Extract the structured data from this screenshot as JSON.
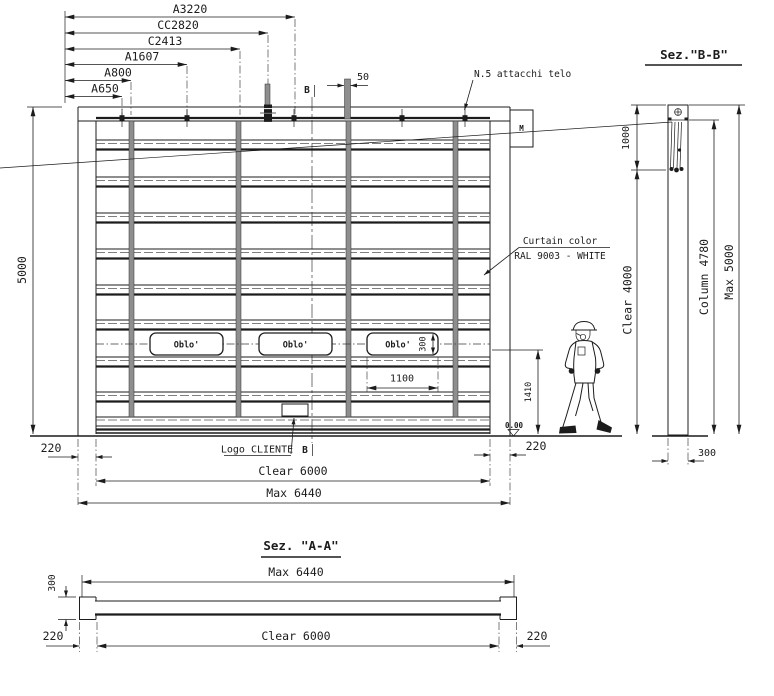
{
  "colors": {
    "ink": "#1c1c1c",
    "belt_gray": "#8e8e8e",
    "background": "#ffffff"
  },
  "top_dimensions": {
    "a3220": "A3220",
    "cc2820": "CC2820",
    "c2413": "C2413",
    "a1607": "A1607",
    "a800": "A800",
    "a650": "A650",
    "strap_50": "50"
  },
  "labels": {
    "attachments_note": "N.5 attacchi telo",
    "curtain_color_line1": "Curtain color",
    "curtain_color_line2": "RAL 9003 - WHITE",
    "logo_note": "Logo CLIENTE",
    "motor": "M",
    "section_marker": "B",
    "floor_level": "0.00",
    "window": "Oblo'"
  },
  "front_view": {
    "total_height": "5000",
    "window_width": "1100",
    "window_height": "300",
    "handle_height": "1410",
    "offset_left": "220",
    "offset_right": "220",
    "clear_width": "Clear 6000",
    "max_width": "Max 6440"
  },
  "section_bb": {
    "title": "Sez.\"B-B\"",
    "roll_zone": "1000",
    "clear_height": "Clear 4000",
    "column_height": "Column 4780",
    "max_height": "Max 5000",
    "column_depth": "300"
  },
  "section_aa": {
    "title": "Sez. \"A-A\"",
    "max_width": "Max 6440",
    "clear_width": "Clear 6000",
    "offset_left": "220",
    "offset_right": "220",
    "beam_depth": "300"
  }
}
